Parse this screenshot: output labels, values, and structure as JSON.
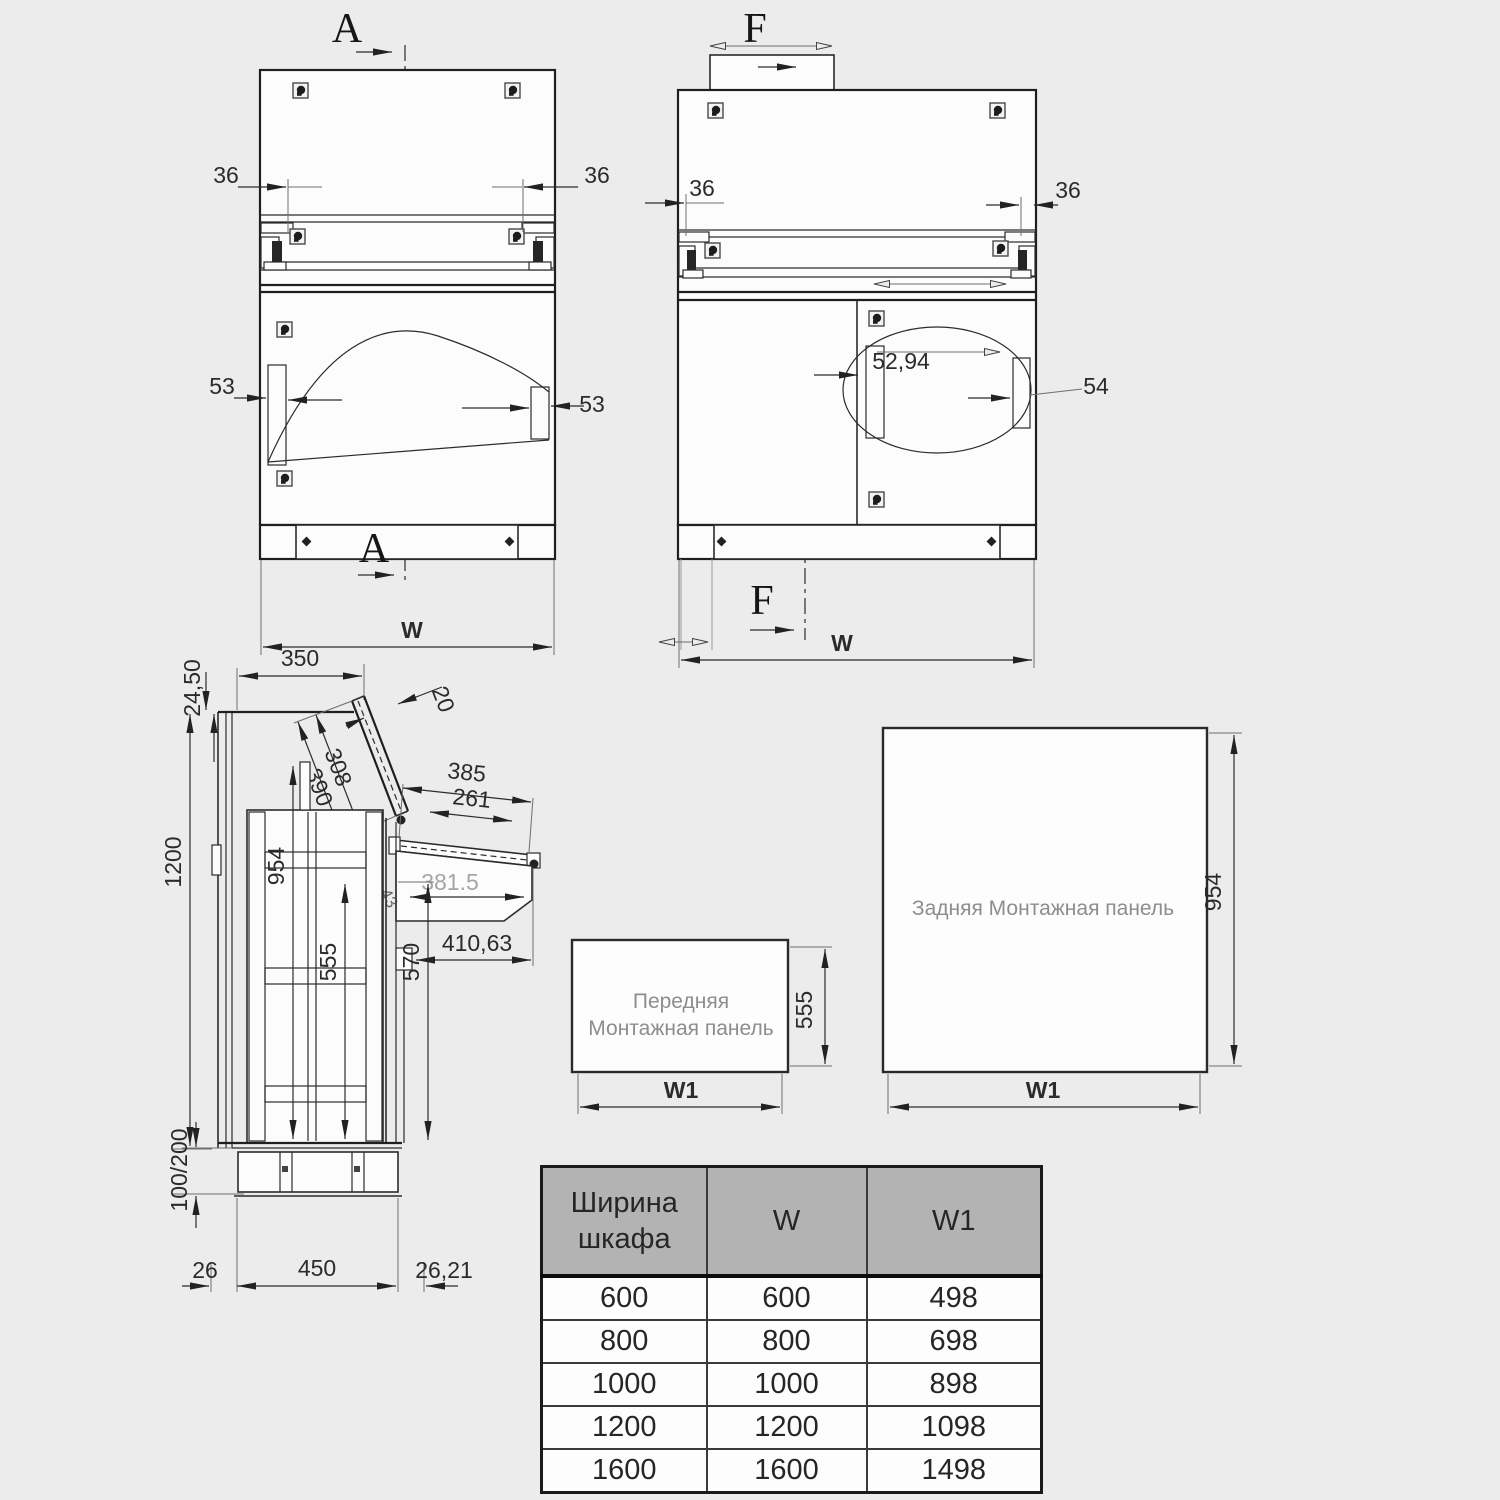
{
  "front_view": {
    "section_top": "A",
    "section_bottom": "A",
    "dim_left_offset": "36",
    "dim_right_offset": "36",
    "dim_rail_left": "53",
    "dim_rail_right": "53",
    "dim_width": "W"
  },
  "rear_view": {
    "section_top": "F",
    "section_bottom": "F",
    "dim_left_offset": "36",
    "dim_right_offset": "36",
    "dim_rail_inner": "52,94",
    "dim_rail_right": "54",
    "dim_width": "W"
  },
  "side_view": {
    "dim_top_offset": "24,50",
    "dim_top_depth": "350",
    "dim_lid_thickness": "20",
    "dim_lid_inner": "308",
    "dim_lid_outer": "390",
    "dim_tray_outer": "385",
    "dim_tray_inner": "261",
    "dim_desk_depth": "381.5",
    "dim_desk_total": "410,63",
    "dim_hinge": "43",
    "dim_rail_height": "954",
    "dim_height": "1200",
    "dim_inner_height": "555",
    "dim_front_height": "570",
    "dim_plinth_height": "100/200",
    "dim_bottom_left": "26",
    "dim_bottom_depth": "450",
    "dim_bottom_right": "26,21"
  },
  "front_panel": {
    "title_line1": "Передняя",
    "title_line2": "Монтажная панель",
    "dim_height": "555",
    "dim_width": "W1"
  },
  "rear_panel": {
    "title": "Задняя Монтажная панель",
    "dim_height": "954",
    "dim_width": "W1"
  },
  "size_table": {
    "col_cabinet_width": "Ширина шкафа",
    "col_w": "W",
    "col_w1": "W1",
    "rows": [
      [
        "600",
        "600",
        "498"
      ],
      [
        "800",
        "800",
        "698"
      ],
      [
        "1000",
        "1000",
        "898"
      ],
      [
        "1200",
        "1200",
        "1098"
      ],
      [
        "1600",
        "1600",
        "1498"
      ]
    ]
  }
}
